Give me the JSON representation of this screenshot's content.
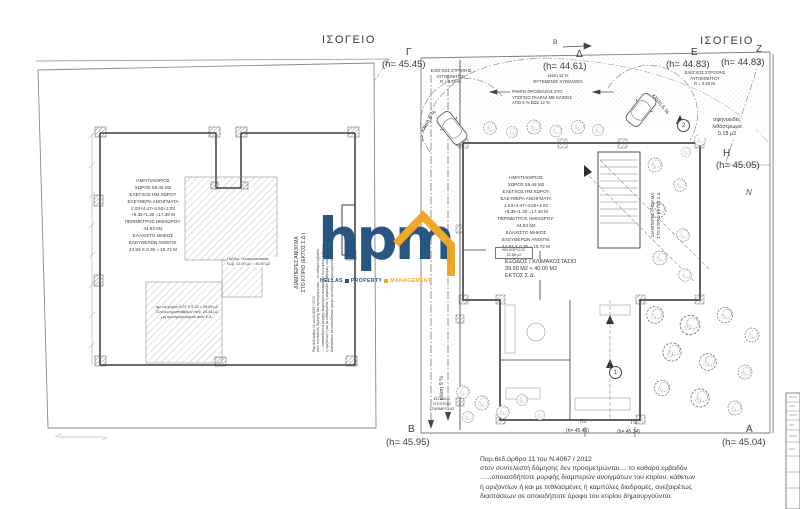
{
  "palette": {
    "ink": "#3a3a3a",
    "line_gray": "#8a8a8a",
    "brand_blue": "#1c4e7b",
    "brand_orange": "#f0a41e"
  },
  "left_plan": {
    "title": "ΙΣΟΓΕΙΟ",
    "hatch_note": [
      "ημ.υπ.χώρος 5.07 Χ 5.15 = 26.09 μ2",
      "Σύνολο ημιυπαιθρίων στεγ. 24.44 μ2",
      "μη προσμετρούμενα στον Σ.Δ."
    ],
    "sidewalk_note": [
      "Πεζόδρ. Ηλιοπροστασίας",
      "Εμβ. 12.09 μ2 = 40.50 μ2"
    ],
    "vertical_label": [
      "ΔΙΑΜΠΕΡΕΣ ΑΝΟΙΓΜΑ",
      "ΣΤΟ ΚΤΙΡΙΟ (ΕΚΤΟΣ Σ.Δ.)"
    ]
  },
  "stats": [
    "ΗΜΙΥΠΑΙΘΡΙΟΣ",
    "ΧΩΡΟΣ 59.45 Μ2",
    "ΕΛΕΓΧΟΣ ΗΜ.ΧΩΡΟΥ",
    "ΕΛΕΥΘΕΡΑ ΑΝΟΙΓΜΑΤΑ",
    "2.03+4.47+4.50+3.03",
    "+6.35+1.30 =17.38 Μ",
    "ΠΕΡΙΜΕΤΡΟΣ ΗΜΙΧΩΡΟΥ:",
    "44.93 Μ2",
    "ΕΛΑΧΙΣΤΟ ΜΗΚΟΣ",
    "ΕΛΕΥΘΕΡΩΝ ΑΝΟΙΓΜ.",
    "44.93 Χ 0.35 = 15.72 Μ"
  ],
  "right_plan": {
    "title": "ΙΣΟΓΕΙΟ",
    "corners": {
      "g": {
        "letter": "Γ",
        "h": "(h= 45.45)"
      },
      "d": {
        "letter": "Δ",
        "h": "(h= 44.61)"
      },
      "e": {
        "letter": "E",
        "h": "(h= 44.83)"
      },
      "z": {
        "letter": "Z",
        "h": "(h= 44.83)"
      },
      "h": {
        "letter": "H",
        "h": "(h= 45.05)"
      },
      "b": {
        "letter": "B",
        "h": "(h= 45.95)"
      },
      "a": {
        "letter": "A",
        "h": "(h= 45.04)"
      },
      "p1": {
        "letter": "Π1",
        "h": "(h= 45.45)"
      },
      "p2": {
        "letter": "Π2",
        "h": "(h= 45.34)"
      }
    },
    "turn_left": [
      "ΕΛΕΓΧΟΣ ΣΤΡΟΦΗΣ",
      "ΑΥΤΟΚΙΝΗΤΟΥ",
      "R > 3.50 Μ."
    ],
    "turn_right": [
      "ΕΛΕΓΧΟΣ ΣΤΡΟΦΗΣ",
      "ΑΥΤΟΚΙΝΗΤΟΥ",
      "R = 3.50 Μ."
    ],
    "slope_note": [
      "κλίση 12 %",
      "ΦΥΤΕΜΕΝΟΙ ΚΥΒΟΛΙΘΟΙ"
    ],
    "ramp_note": [
      "ΡΑΜΠΑ ΠΡΟΣΒΑΣΗΣ ΣΤΟ",
      "ΥΠΟΓΕΙΟ ΓΚΑΡΑΖ ΜΕ ΚΛΙΣΕΙΣ",
      "ΑΠΟ 6 % ΕΩΣ 12 %"
    ],
    "wedge_note": [
      "σφηνοειδές",
      "λιθόστρωμα",
      "0.18 μ2"
    ],
    "exit_note": [
      "ΕΞΟΔΟΣ / ΚΛΙΜΑΚΟΣΤΑΣΙΟ",
      "39.90 Μ2 < 40.00 Μ2",
      "ΕΚΤΟΣ Σ.Δ."
    ],
    "area_tag": [
      "ΗΜ.ΧΩΡ.ΙΣΟΓ.",
      "22.86 μ2"
    ],
    "garage_tag": [
      "ΕΙΣΟΔΟΣ",
      "ΥΠΟΓΕΙΑΣ",
      "ΣΤΑΘΜΕΥΣΗΣ"
    ],
    "slope_12": "κλίση 12 %",
    "slope_9": "κλίση 9 %",
    "slope_6": "κλίση 6 %",
    "vertical_label": [
      "ΔΙΑΜΠΕΡΕΣ ΑΝΟΙΓΜΑ",
      "ΣΤΟ ΚΤΙΡΙΟ ΕΚΤΟΣ Σ.Δ."
    ],
    "grid_1": "1",
    "grid_2": "2",
    "section_mark": "B",
    "north": "N"
  },
  "watermark": {
    "word": "hpm",
    "tagline_1": "HELLAS",
    "tagline_2": "PROPERTY",
    "tagline_3": "MANAGEMENT"
  },
  "footnote": {
    "lines": [
      "Παρ.6εδ.άρθρο 11 του Ν.4067 / 2012",
      "στον συντελεστή δόμησης δεν προσμετρώνται.... το καθαρό εμβαδόν",
      "......οποιασδήποτε μορφής διαμπερών ανοιγμάτων του κτιρίου, κάθετων",
      "ή οριζοντίων ή και με τεθλασμένες ή καμπύλες διαδρομές, ανεξαιρέτως",
      "διαστάσεων σε οποιοδήποτε όροφο του κτιρίου δημιουργούνται."
    ]
  }
}
